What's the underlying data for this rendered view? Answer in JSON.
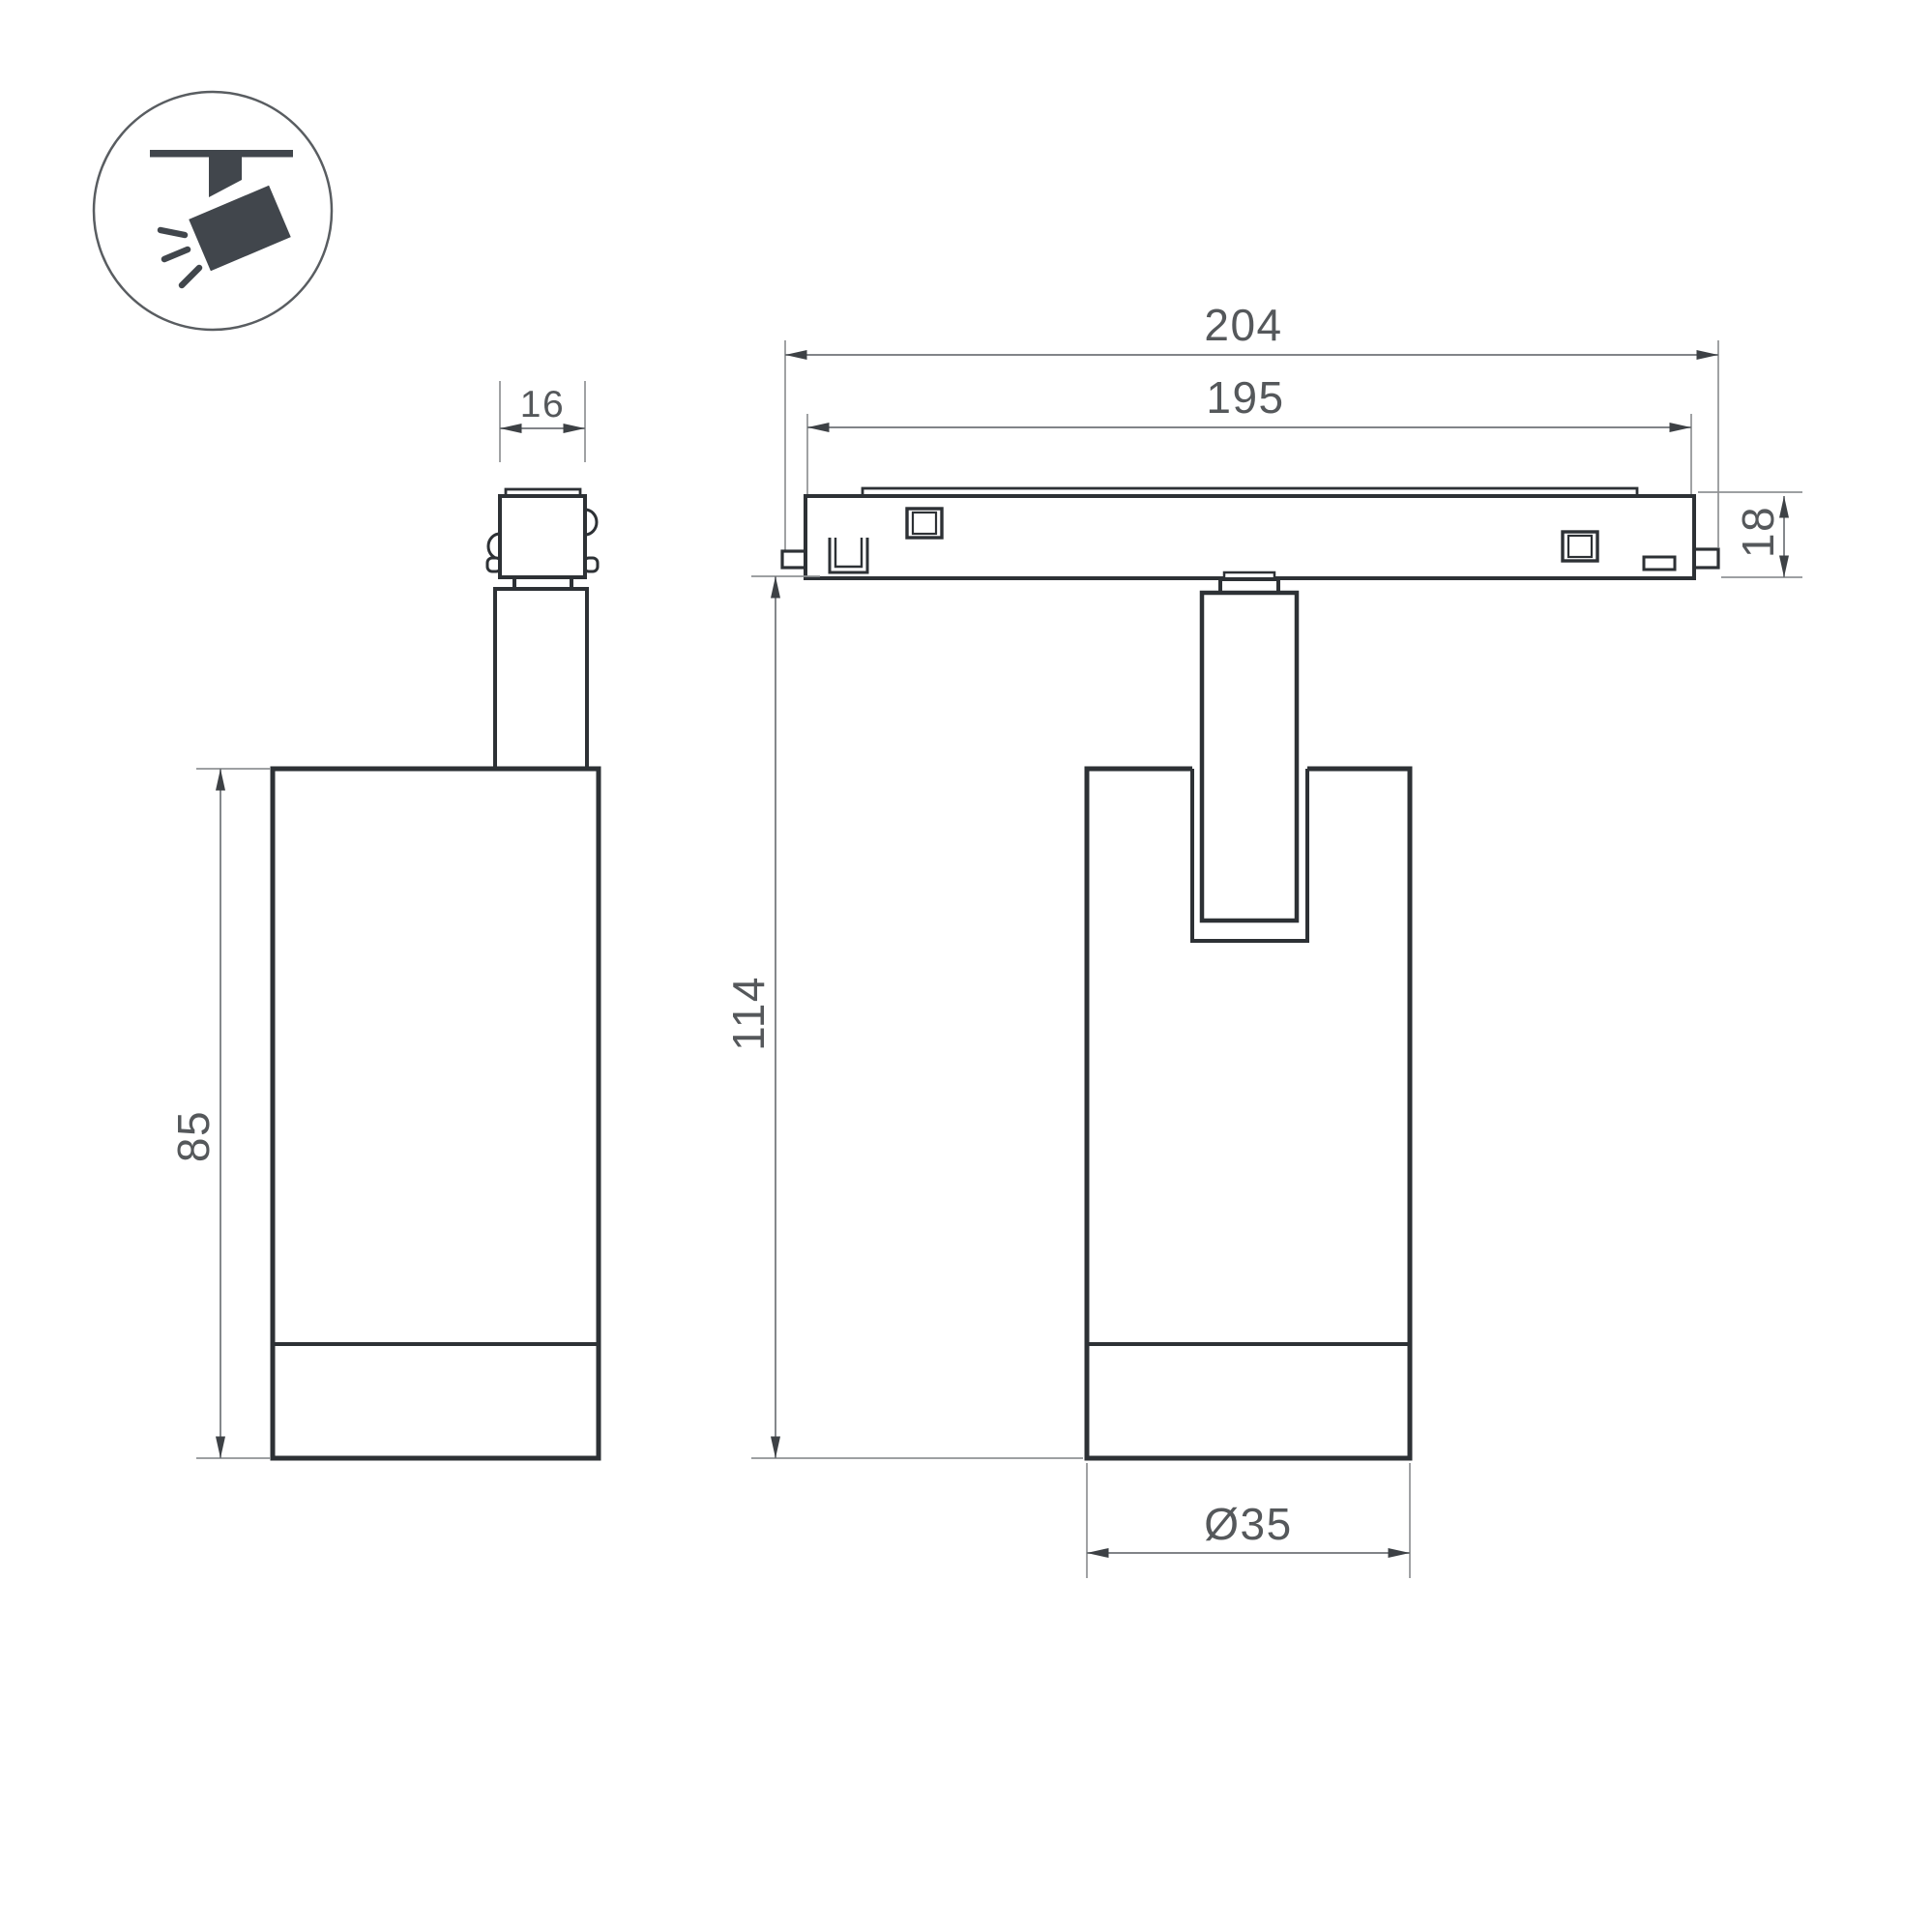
{
  "drawing": {
    "kind": "technical-dimension-drawing",
    "icon": {
      "name": "track-spotlight-icon"
    },
    "views": [
      {
        "id": "side-view",
        "description": "side view of spotlight with track adapter"
      },
      {
        "id": "front-view",
        "description": "front view of spotlight mounted on magnetic track"
      }
    ]
  },
  "dimensions": {
    "connector_width": "16",
    "body_height": "85",
    "overall_length": "204",
    "track_length": "195",
    "track_height": "18",
    "overall_height": "114",
    "body_diameter": "Ø35"
  },
  "colors": {
    "background": "#ffffff",
    "outline": "#2d3135",
    "dimension_line": "#6f7377",
    "extension_line": "#8f9294",
    "arrowhead": "#3d4145",
    "text": "#55585b",
    "icon": "#41464c"
  }
}
